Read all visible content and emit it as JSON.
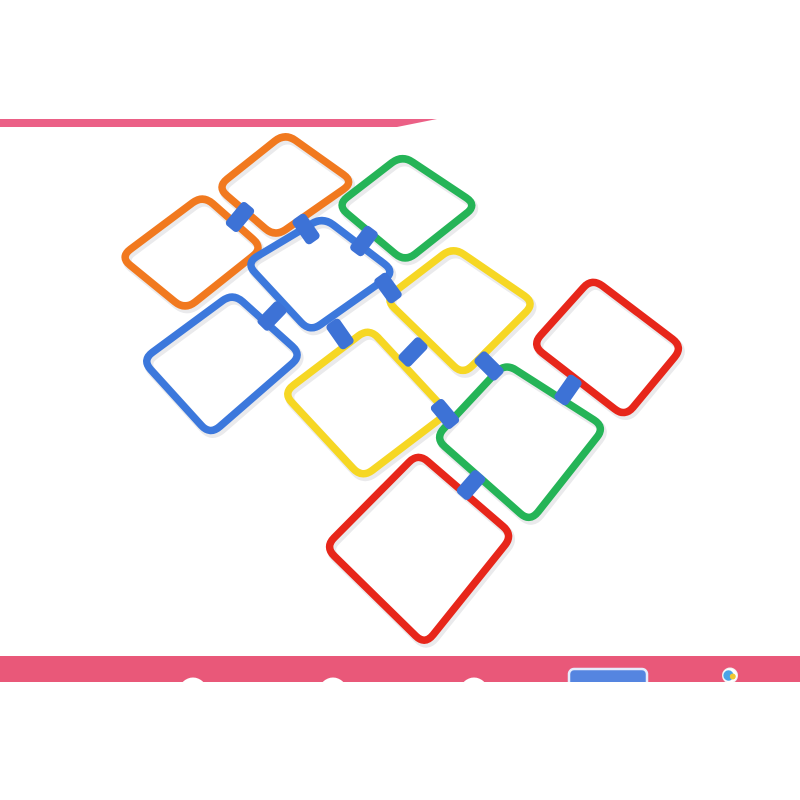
{
  "alt": "Product photo: ten colorful square plastic hopscotch rings (orange, green, blue, yellow, red) laid on a white floor, linked together with blue connector clips; pink banner stripe at top and pink bar at bottom",
  "canvas": {
    "width": 800,
    "height": 800,
    "background": "#ffffff"
  },
  "top_stripe": {
    "color": "#eb6086",
    "points": [
      [
        0,
        119
      ],
      [
        437,
        119
      ],
      [
        397,
        127
      ],
      [
        0,
        127
      ]
    ]
  },
  "bottom_bar": {
    "color": "#e95879",
    "x": 0,
    "y": 656,
    "width": 800,
    "height": 26,
    "dots": {
      "color": "#ffffff",
      "radius": 14,
      "cy": 691.5,
      "cx": [
        193,
        333,
        474
      ]
    },
    "badge": {
      "x": 569,
      "y": 669,
      "width": 78,
      "height": 26,
      "rx": 5,
      "fill": "#5585e0",
      "stroke": "#e6ecfc"
    },
    "logo": {
      "cx": 730,
      "cy": 675.5,
      "r": 7.5,
      "ring": "#f0f0f0",
      "base": "#ffffff",
      "blue": "#4aa3e8",
      "yellow": "#f0c832"
    }
  },
  "ring_style": {
    "stroke_width": 7.5,
    "corner_radius": 13,
    "shadow": "rgba(140,140,150,0.18)",
    "shadow_dx": 2,
    "shadow_dy": 3
  },
  "rings": [
    {
      "id": "orange-top",
      "color": "#f1791f",
      "points": [
        [
          285,
          133
        ],
        [
          354,
          182
        ],
        [
          275,
          237
        ],
        [
          217,
          187
        ]
      ]
    },
    {
      "id": "green-top",
      "color": "#25b457",
      "points": [
        [
          402,
          155
        ],
        [
          477,
          205
        ],
        [
          405,
          262
        ],
        [
          337,
          205
        ]
      ]
    },
    {
      "id": "orange-left",
      "color": "#f1791f",
      "points": [
        [
          203,
          195
        ],
        [
          263,
          248
        ],
        [
          185,
          310
        ],
        [
          120,
          257
        ]
      ]
    },
    {
      "id": "blue-center",
      "color": "#3c78dc",
      "points": [
        [
          323,
          217
        ],
        [
          395,
          272
        ],
        [
          310,
          332
        ],
        [
          246,
          263
        ]
      ]
    },
    {
      "id": "yellow-right",
      "color": "#f6d724",
      "points": [
        [
          453,
          247
        ],
        [
          535,
          303
        ],
        [
          463,
          375
        ],
        [
          385,
          299
        ]
      ]
    },
    {
      "id": "red-right",
      "color": "#e7261a",
      "points": [
        [
          592,
          278
        ],
        [
          683,
          347
        ],
        [
          625,
          417
        ],
        [
          532,
          345
        ]
      ]
    },
    {
      "id": "blue-left",
      "color": "#3c78dc",
      "points": [
        [
          233,
          293
        ],
        [
          302,
          355
        ],
        [
          210,
          435
        ],
        [
          142,
          360
        ]
      ]
    },
    {
      "id": "yellow-center",
      "color": "#f6d724",
      "points": [
        [
          369,
          328
        ],
        [
          448,
          413
        ],
        [
          362,
          478
        ],
        [
          283,
          393
        ]
      ]
    },
    {
      "id": "green-right",
      "color": "#25b457",
      "points": [
        [
          505,
          363
        ],
        [
          605,
          427
        ],
        [
          530,
          522
        ],
        [
          435,
          438
        ]
      ]
    },
    {
      "id": "red-bottom",
      "color": "#e7261a",
      "points": [
        [
          418,
          453
        ],
        [
          513,
          535
        ],
        [
          425,
          645
        ],
        [
          325,
          547
        ]
      ]
    }
  ],
  "clip_style": {
    "width": 16,
    "height": 30,
    "rx": 4,
    "color": "#3d72d6"
  },
  "clips": [
    {
      "id": "clip-orangetop-orangeleft",
      "x": 240,
      "y": 217,
      "rot": 40
    },
    {
      "id": "clip-orangetop-bluecenter",
      "x": 306,
      "y": 229,
      "rot": -35
    },
    {
      "id": "clip-greentop-bluecenter",
      "x": 364,
      "y": 241,
      "rot": 37
    },
    {
      "id": "clip-bluecenter-yellowright",
      "x": 388,
      "y": 288,
      "rot": -36
    },
    {
      "id": "clip-bluecenter-blueleft",
      "x": 272,
      "y": 316,
      "rot": 44
    },
    {
      "id": "clip-bluecenter-yellowcenter",
      "x": 340,
      "y": 334,
      "rot": -35
    },
    {
      "id": "clip-yellowright-yellowcenter",
      "x": 413,
      "y": 352,
      "rot": 44
    },
    {
      "id": "clip-yellowright-greenright",
      "x": 489,
      "y": 366,
      "rot": -45
    },
    {
      "id": "clip-redright-greenright",
      "x": 568,
      "y": 390,
      "rot": 35
    },
    {
      "id": "clip-yellowcenter-greenright",
      "x": 445,
      "y": 414,
      "rot": -40
    },
    {
      "id": "clip-greenright-redbottom",
      "x": 471,
      "y": 485,
      "rot": 41
    }
  ]
}
